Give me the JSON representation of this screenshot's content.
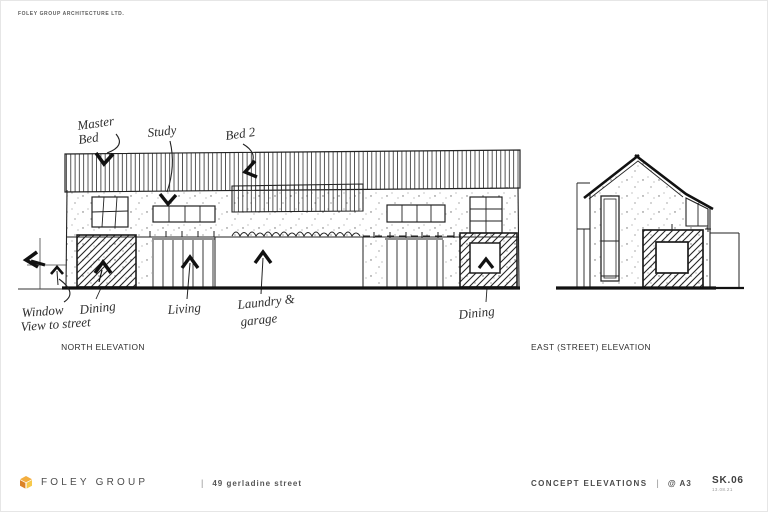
{
  "sheet": {
    "firm_header": "FOLEY GROUP ARCHITECTURE LTD.",
    "paper_color": "#ffffff",
    "ink_color": "#1f1f1f"
  },
  "north_elevation": {
    "caption": "NORTH ELEVATION",
    "annotations": {
      "master_bed_line1": "Master",
      "master_bed_line2": "Bed",
      "study": "Study",
      "bed_2": "Bed 2",
      "window_view_line1": "Window",
      "window_view_line2": "View to street",
      "dining_left": "Dining",
      "living": "Living",
      "laundry_line1": "Laundry &",
      "laundry_line2": "garage",
      "dining_right": "Dining"
    }
  },
  "east_elevation": {
    "caption": "EAST (STREET) ELEVATION"
  },
  "footer": {
    "logo_icon": "foley-cube-logo",
    "logo_text": "FOLEY GROUP",
    "divider": "|",
    "project_address": "49 gerladine street",
    "drawing_title": "CONCEPT ELEVATIONS",
    "divider2": "|",
    "paper_size": "@ A3",
    "sheet_number": "SK.06",
    "revision_date": "13.08.21",
    "brand_top": "#F3AE3F",
    "brand_left": "#DB8328",
    "brand_right": "#F7C94B"
  }
}
